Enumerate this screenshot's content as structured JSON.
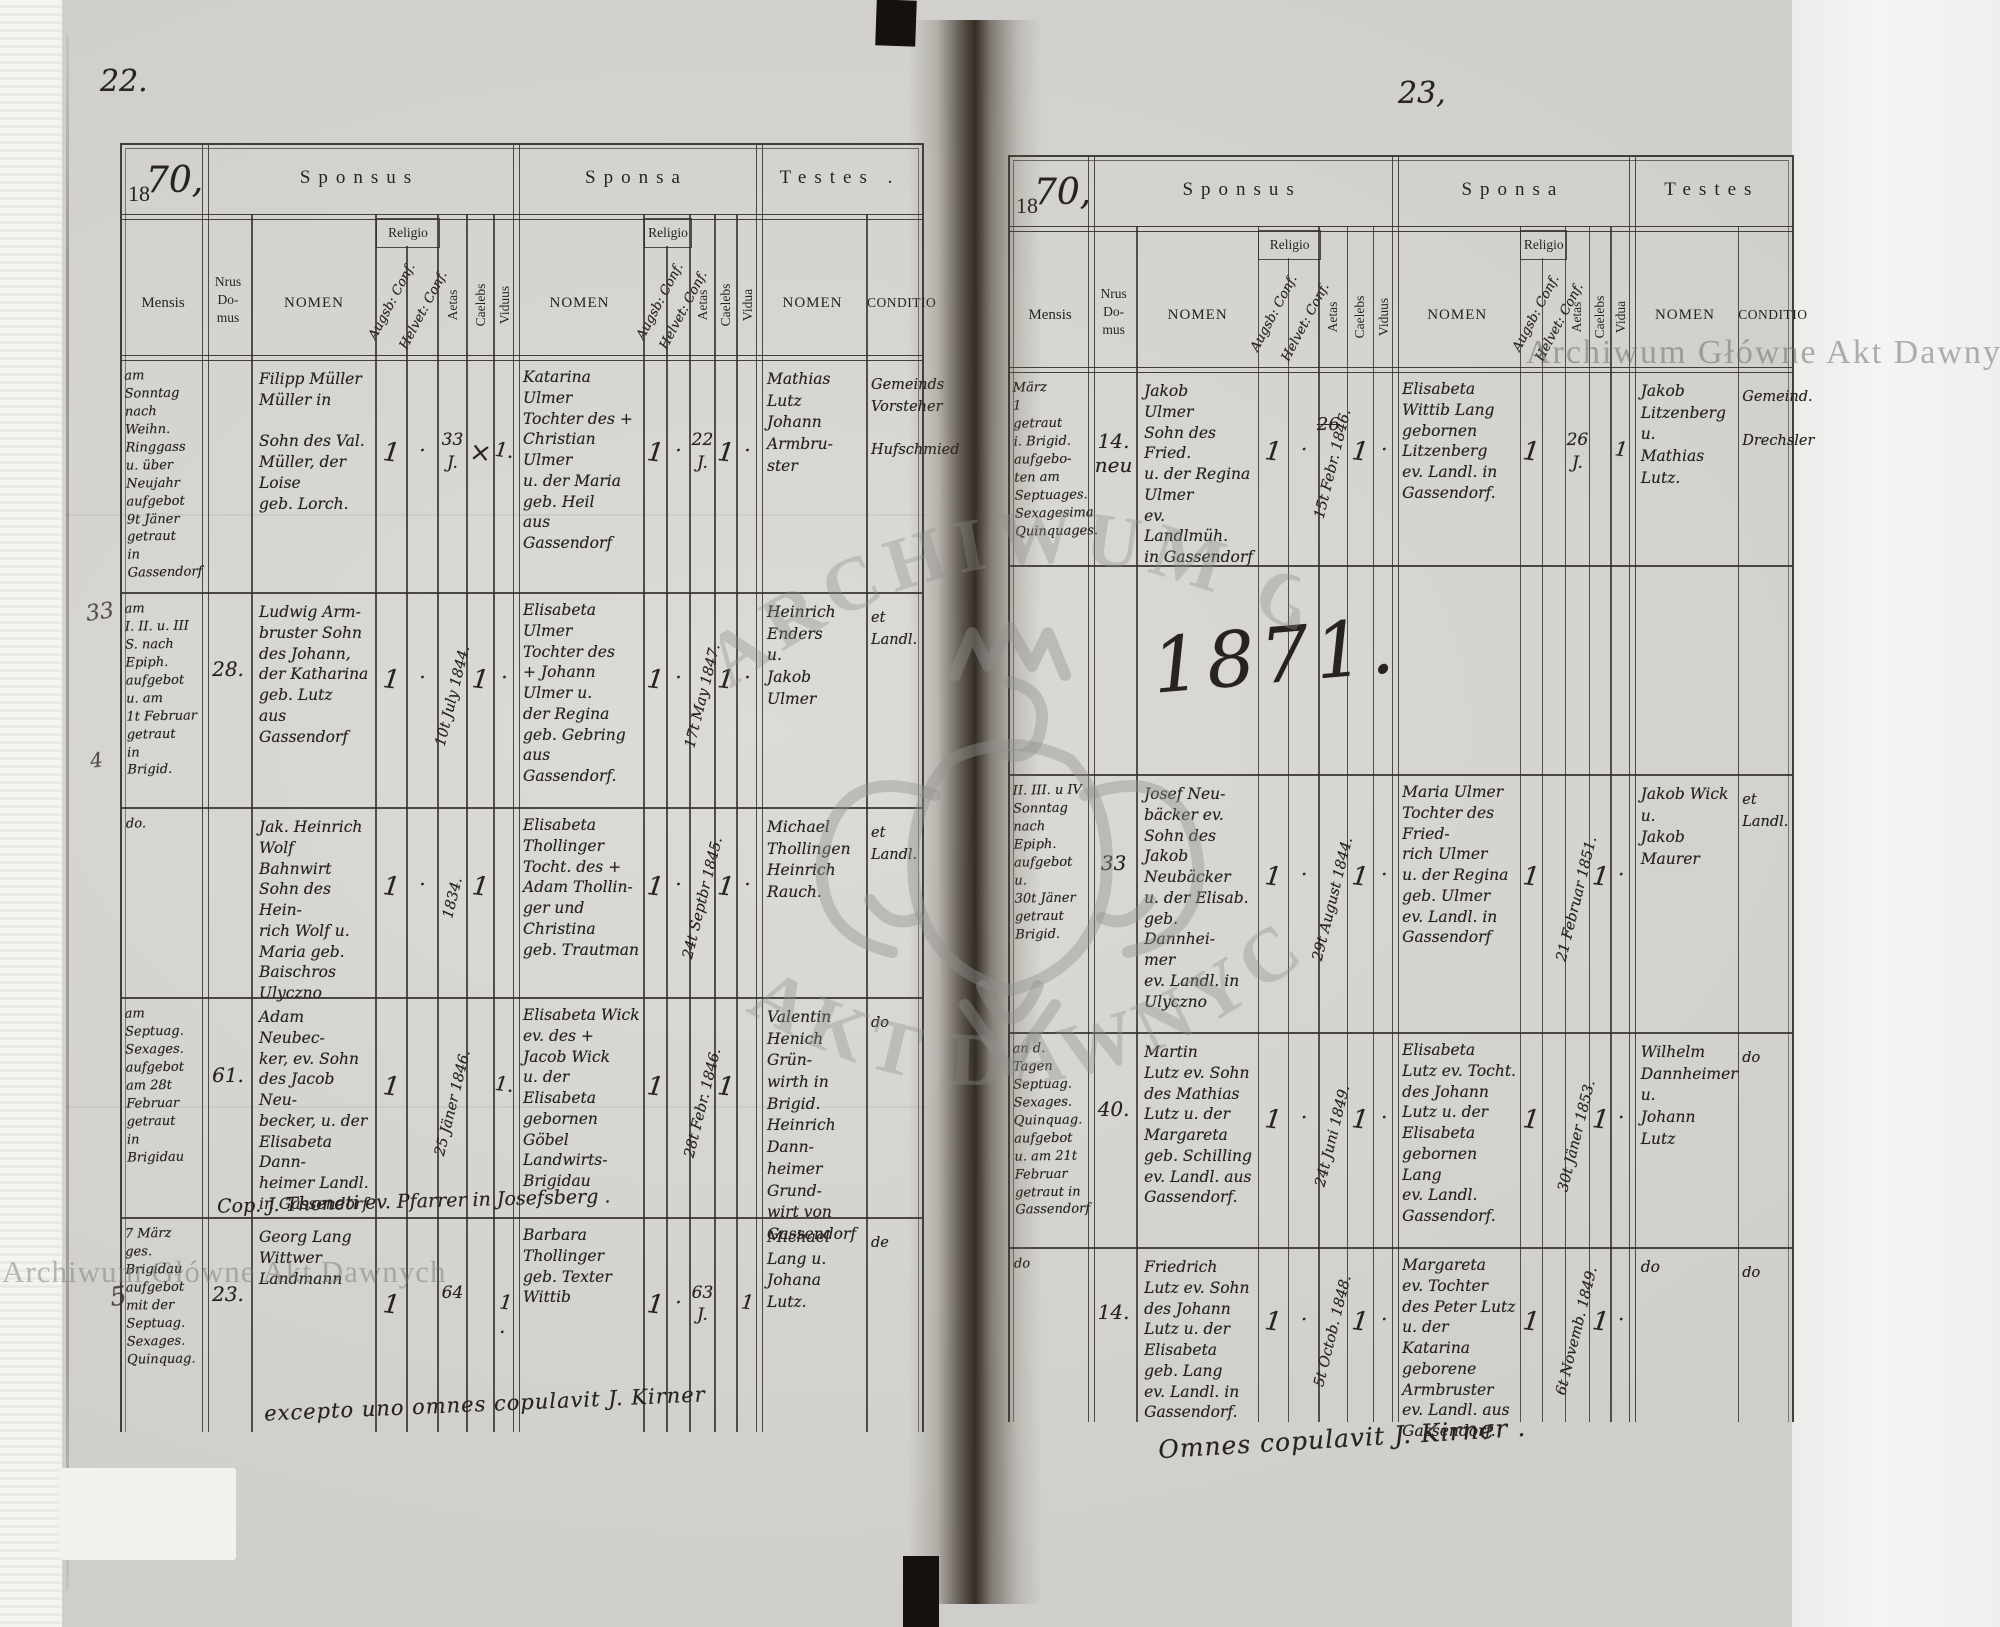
{
  "watermark": {
    "text": "Archiwum Główne Akt Dawnych",
    "arc_top": "ARCHIWUM GŁÓWNE",
    "arc_bottom": "AKT DAWNYCH"
  },
  "labels": {
    "year_print": "18",
    "mensis": "Mensis",
    "nrus": "Nrus\nDo-\nmus",
    "nomen": "NOMEN",
    "religio": "Religio",
    "augsb": "Augsb: Conf.",
    "helvet": "Helvet: Conf.",
    "aetas": "Aetas",
    "caelebs": "Caelebs",
    "viduus": "Viduus",
    "vidua": "Vidua",
    "conditio": "CONDITIO"
  },
  "left_page": {
    "page_number": "22.",
    "year_hand": "70,",
    "sections": {
      "sponsus": "Sponsus",
      "sponsa": "Sponsa",
      "testes": "Testes ."
    },
    "footer": "excepto uno omnes copulavit J. Kirner",
    "margin_marks": [
      "33",
      "4",
      "5"
    ],
    "rows": [
      {
        "mensis": "am\nSonntag\nnach\nWeihn.\nRinggass\nu. über\nNeujahr\naufgebot\n9t Jäner\ngetraut\nin\nGassendorf",
        "domus": "",
        "sponsus_nomen": "Filipp Müller\nMüller in\n\nSohn des Val.\nMüller, der\nLoise\ngeb. Lorch.",
        "s_rel_a": "1",
        "s_rel_h": "·",
        "s_aetas": "33\nJ.",
        "s_aetas_vert": false,
        "s_cael": "×",
        "s_vid": "1.",
        "sponsa_nomen": "Katarina\nUlmer\nTochter des +\nChristian\nUlmer\nu. der Maria\ngeb. Heil\naus\nGassendorf",
        "b_rel_a": "1",
        "b_rel_h": "·",
        "b_aetas": "22\nJ.",
        "b_aetas_vert": false,
        "b_cael": "1",
        "b_vid": "·",
        "testes_nomen": "Mathias\nLutz\nJohann\nArmbru-\nster",
        "conditio": "Gemeinds\nVorsteher\n\nHufschmied"
      },
      {
        "mensis": "am\nI. II. u. III\nS. nach\nEpiph.\naufgebot\nu. am\n1t Februar\ngetraut\nin\nBrigid.",
        "domus": "28.",
        "sponsus_nomen": "Ludwig Arm-\nbruster Sohn\ndes Johann,\nder Katharina\ngeb. Lutz\naus Gassendorf",
        "s_rel_a": "1",
        "s_rel_h": "·",
        "s_aetas": "10t July 1844.",
        "s_aetas_vert": true,
        "s_cael": "1",
        "s_vid": "·",
        "sponsa_nomen": "Elisabeta\nUlmer\nTochter des\n+ Johann\nUlmer u.\nder Regina\ngeb. Gebring\naus Gassendorf.",
        "b_rel_a": "1",
        "b_rel_h": "·",
        "b_aetas": "17t May 1847.",
        "b_aetas_vert": true,
        "b_cael": "1",
        "b_vid": "·",
        "testes_nomen": "Heinrich\nEnders\nu.\nJakob\nUlmer",
        "conditio": "et\nLandl."
      },
      {
        "mensis": "do.",
        "domus": "",
        "sponsus_nomen": "Jak. Heinrich\nWolf\nBahnwirt\nSohn des Hein-\nrich Wolf u.\nMaria geb.\nBaischros\nUlyczno",
        "s_rel_a": "1",
        "s_rel_h": "·",
        "s_aetas": "1834.",
        "s_aetas_vert": true,
        "s_cael": "1",
        "s_vid": "",
        "sponsa_nomen": "Elisabeta\nThollinger\nTocht. des +\nAdam Thollin-\nger und\nChristina\ngeb. Trautman",
        "b_rel_a": "1",
        "b_rel_h": "·",
        "b_aetas": "24t Septbr 1845.",
        "b_aetas_vert": true,
        "b_cael": "1",
        "b_vid": "·",
        "testes_nomen": "Michael\nThollingen\nHeinrich\nRauch.",
        "conditio": "et\nLandl."
      },
      {
        "mensis": "am Septuag.\nSexages.\naufgebot\nam 28t\nFebruar\ngetraut\nin\nBrigidau",
        "domus": "61.",
        "sponsus_nomen": "Adam Neubec-\nker, ev. Sohn\ndes Jacob Neu-\nbecker, u. der\nElisabeta Dann-\nheimer Landl.\nin Gassendorf",
        "s_rel_a": "1",
        "s_rel_h": "",
        "s_aetas": "25 Jäner 1846.",
        "s_aetas_vert": true,
        "s_cael": "",
        "s_vid": "1.",
        "sponsa_nomen": "Elisabeta Wick\nev. des +\nJacob Wick\nu. der Elisabeta\ngebornen Göbel\nLandwirts-\nBrigidau",
        "b_rel_a": "1",
        "b_rel_h": "",
        "b_aetas": "28t Febr. 1846.",
        "b_aetas_vert": true,
        "b_cael": "1",
        "b_vid": "",
        "testes_nomen": "Valentin\nHenich Grün-\nwirth in Brigid.\nHeinrich Dann-\nheimer Grund-\nwirt von\nGassendorf",
        "conditio": "do",
        "note": "Cop. J. Thoneti ev. Pfarrer in Josefsberg ."
      },
      {
        "mensis": "7 März\nges.\nBrigidau\naufgebot\nmit der\nSeptuag.\nSexages.\nQuinquag.",
        "domus": "23.",
        "sponsus_nomen": "Georg Lang\nWittwer\nLandmann",
        "s_rel_a": "1",
        "s_rel_h": "",
        "s_aetas": "64",
        "s_aetas_vert": false,
        "s_cael": "",
        "s_vid": "1 .",
        "sponsa_nomen": "Barbara\nThollinger\ngeb. Texter\nWittib",
        "b_rel_a": "1",
        "b_rel_h": "·",
        "b_aetas": "63\nJ.",
        "b_aetas_vert": false,
        "b_cael": "",
        "b_vid": "1",
        "testes_nomen": "Michael\nLang u.\nJohana\nLutz.",
        "conditio": "de"
      }
    ]
  },
  "right_page": {
    "page_number": "23,",
    "year_hand": "70,",
    "year_band": "1871.",
    "sections": {
      "sponsus": "Sponsus",
      "sponsa": "Sponsa",
      "testes": "Testes"
    },
    "footer": "Omnes copulavit J. Kirner .",
    "rows": [
      {
        "mensis": "März\n1\ngetraut\ni. Brigid.\naufgebo-\nten am\nSeptuages.\nSexagesima\nQuinquages.",
        "domus": "14.\nneu",
        "sponsus_nomen": "Jakob\nUlmer\nSohn des Fried.\nu. der Regina\nUlmer\nev. Landlmüh.\nin Gassendorf",
        "s_rel_a": "1",
        "s_rel_h": "·",
        "s_aetas": "15t Febr. 1846.",
        "s_aetas_vert": true,
        "s_aetas_x": "26",
        "s_cael": "1",
        "s_vid": "·",
        "sponsa_nomen": "Elisabeta\nWittib Lang\ngebornen\nLitzenberg\nev. Landl. in\nGassendorf.",
        "b_rel_a": "1",
        "b_rel_h": "",
        "b_aetas": "26\nJ.",
        "b_aetas_vert": false,
        "b_cael": "",
        "b_vid": "1",
        "testes_nomen": "Jakob\nLitzenberg\nu.\nMathias\nLutz.",
        "conditio": "Gemeind.\n\nDrechsler"
      },
      {
        "mensis": "II. III. u IV\nSonntag\nnach\nEpiph.\naufgebot\nu.\n30t Jäner\ngetraut\nBrigid.",
        "domus": "33",
        "sponsus_nomen": "Josef Neu-\nbäcker ev.\nSohn des Jakob\nNeubäcker\nu. der Elisab.\ngeb. Dannhei-\nmer\nev. Landl. in\nUlyczno",
        "s_rel_a": "1",
        "s_rel_h": "·",
        "s_aetas": "29t August 1844.",
        "s_aetas_vert": true,
        "s_cael": "1",
        "s_vid": "·",
        "sponsa_nomen": "Maria Ulmer\nTochter des Fried-\nrich Ulmer\nu. der Regina\ngeb. Ulmer\nev. Landl. in\nGassendorf",
        "b_rel_a": "1",
        "b_rel_h": "",
        "b_aetas": "21 Februar 1851.",
        "b_aetas_vert": true,
        "b_cael": "1",
        "b_vid": "·",
        "testes_nomen": "Jakob Wick\nu.\nJakob\nMaurer",
        "conditio": "et\nLandl."
      },
      {
        "mensis": "an d. Tagen\nSeptuag.\nSexages.\nQuinquag.\naufgebot\nu. am 21t\nFebruar\ngetraut in\nGassendorf",
        "domus": "40.",
        "sponsus_nomen": "Martin\nLutz ev. Sohn\ndes Mathias\nLutz u. der\nMargareta\ngeb. Schilling\nev. Landl. aus\nGassendorf.",
        "s_rel_a": "1",
        "s_rel_h": "·",
        "s_aetas": "24t Juni 1849.",
        "s_aetas_vert": true,
        "s_cael": "1",
        "s_vid": "·",
        "sponsa_nomen": "Elisabeta\nLutz ev. Tocht.\ndes Johann\nLutz u. der\nElisabeta\ngebornen\nLang\nev. Landl.\nGassendorf.",
        "b_rel_a": "1",
        "b_rel_h": "",
        "b_aetas": "30t Jäner 1853.",
        "b_aetas_vert": true,
        "b_cael": "1",
        "b_vid": "·",
        "testes_nomen": "Wilhelm\nDannheimer\nu.\nJohann Lutz",
        "conditio": "do"
      },
      {
        "mensis": "do",
        "domus": "14.",
        "sponsus_nomen": "Friedrich\nLutz ev. Sohn\ndes Johann\nLutz u. der\nElisabeta\ngeb. Lang\nev. Landl. in\nGassendorf.",
        "s_rel_a": "1",
        "s_rel_h": "·",
        "s_aetas": "5t Octob. 1848.",
        "s_aetas_vert": true,
        "s_cael": "1",
        "s_vid": "·",
        "sponsa_nomen": "Margareta\nev. Tochter\ndes Peter Lutz\nu. der Katarina\ngeborene\nArmbruster\nev. Landl. aus\nGassendorf.",
        "b_rel_a": "1",
        "b_rel_h": "",
        "b_aetas": "6t Novemb. 1849.",
        "b_aetas_vert": true,
        "b_cael": "1",
        "b_vid": "·",
        "testes_nomen": "do",
        "conditio": "do"
      }
    ]
  }
}
